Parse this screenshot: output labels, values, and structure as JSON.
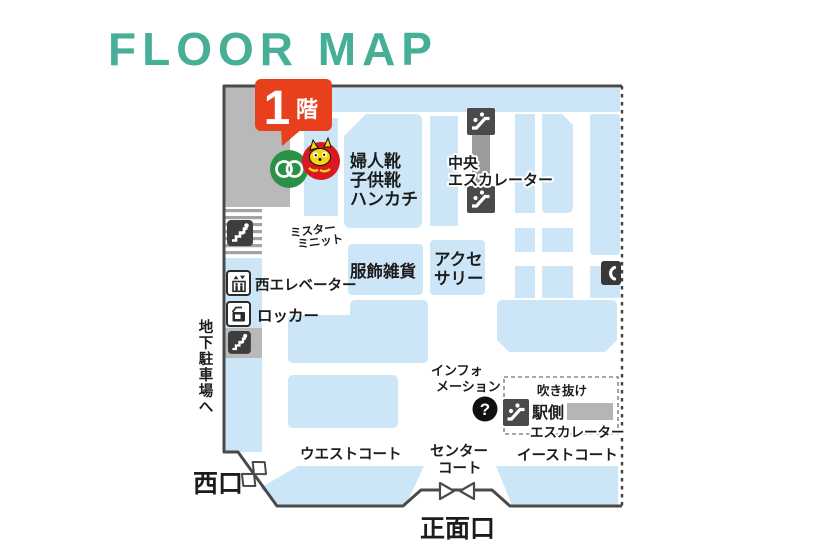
{
  "title": "FLOOR MAP",
  "badge": {
    "number": "1",
    "floor_suffix": "階"
  },
  "labels": {
    "shoes": [
      "婦人靴",
      "子供靴",
      "ハンカチ"
    ],
    "central_escalator": [
      "中央",
      "エスカレーター"
    ],
    "mister_minit": [
      "ミスター",
      "ミニット"
    ],
    "apparel_goods": "服飾雑貨",
    "accessories": [
      "アクセ",
      "サリー"
    ],
    "west_elevator": "西エレベーター",
    "locker": "ロッカー",
    "to_basement_parking": "地下駐車場へ",
    "information": [
      "インフォ",
      "メーション"
    ],
    "information_mark": "?",
    "atrium": "吹き抜け",
    "station_escalator": [
      "駅側",
      "エスカレーター"
    ],
    "west_court": "ウエストコート",
    "center_court": [
      "センター",
      "コート"
    ],
    "east_court": "イーストコート",
    "west_entrance": "西口",
    "main_entrance": "正面口"
  },
  "icons": {
    "escalator": "escalator-icon",
    "stairs": "stairs-icon",
    "elevator": "elevator-icon",
    "locker": "locker-icon",
    "phone": "phone-icon",
    "information": "question-mark-icon",
    "west_door": "swing-door-icon",
    "main_door": "revolving-door-icon",
    "store_logo": "green-rings-logo",
    "mascot": "mascot-badge"
  },
  "colors": {
    "title_teal": "#47ae97",
    "badge_red": "#e8401c",
    "block_blue": "#cde6f7",
    "block_gray": "#b9b9b9",
    "shaft_gray": "#9b9b9b",
    "icon_dark": "#3d3d3d",
    "outline": "#4a4a4a",
    "logo_green": "#2c9148",
    "mascot_red": "#d81920",
    "mascot_yellow": "#f6d50e"
  }
}
